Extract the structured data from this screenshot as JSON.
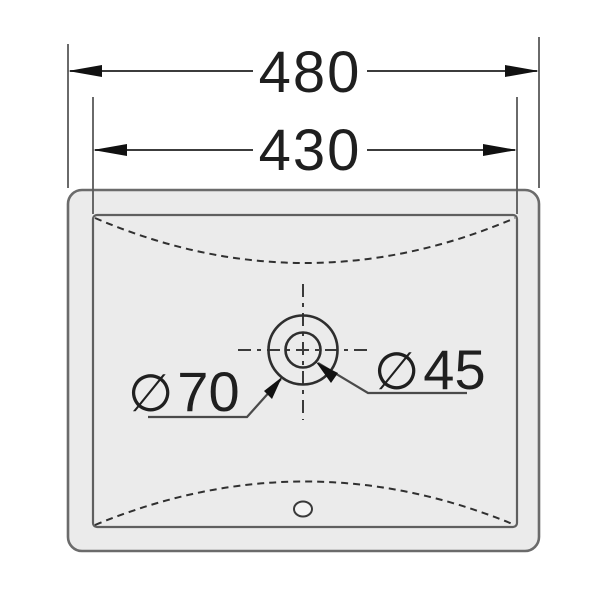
{
  "drawing": {
    "type": "sink-top-view-dimension-drawing",
    "dimensions": {
      "overall_width": "480",
      "basin_width": "430"
    },
    "annotations": {
      "diameter_symbol": "∅",
      "outer_circle_diameter": "70",
      "inner_circle_diameter": "45"
    },
    "colors": {
      "background": "#ffffff",
      "sink_fill": "#ebebeb",
      "outline_gray": "#6b6b6b",
      "line_dark": "#2e2e2e",
      "text": "#1f1f1f",
      "arrow": "#111111"
    }
  }
}
